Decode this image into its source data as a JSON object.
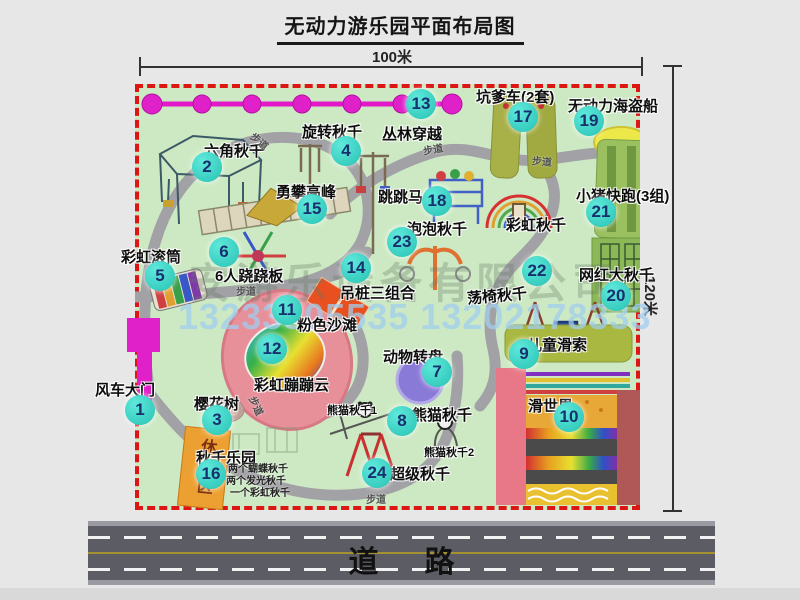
{
  "title": "无动力游乐园平面布局图",
  "dimensions": {
    "width": "100米",
    "height": "120米"
  },
  "road": {
    "label": "道路"
  },
  "watermarks": {
    "company": "安游乐设备有限公司",
    "phone": "13233805535 13202178333"
  },
  "map": {
    "path_label": "步道"
  },
  "attractions": [
    {
      "num": "1",
      "name": "风车大门"
    },
    {
      "num": "2",
      "name": "六角秋千"
    },
    {
      "num": "3",
      "name": "樱花树"
    },
    {
      "num": "4",
      "name": "旋转秋千"
    },
    {
      "num": "5",
      "name": "彩虹滚筒"
    },
    {
      "num": "6",
      "name": "6人跷跷板"
    },
    {
      "num": "7",
      "name": "动物转盘"
    },
    {
      "num": "8",
      "name": "熊猫秋千"
    },
    {
      "num": "9",
      "name": "儿童滑索"
    },
    {
      "num": "10",
      "name": "滑世界"
    },
    {
      "num": "11",
      "name": "粉色沙滩"
    },
    {
      "num": "12",
      "name": "彩虹蹦蹦云"
    },
    {
      "num": "13",
      "name": "丛林穿越"
    },
    {
      "num": "14",
      "name": "吊桩三组合"
    },
    {
      "num": "15",
      "name": "勇攀高峰"
    },
    {
      "num": "16",
      "name": "秋千乐园"
    },
    {
      "num": "17",
      "name": "坑爹车(2套)"
    },
    {
      "num": "18",
      "name": "跳跳马"
    },
    {
      "num": "19",
      "name": "无动力海盗船"
    },
    {
      "num": "20",
      "name": "网红大秋千"
    },
    {
      "num": "21",
      "name": "小猪快跑(3组)"
    },
    {
      "num": "22",
      "name": "荡椅秋千"
    },
    {
      "num": "23",
      "name": "泡泡秋千"
    },
    {
      "num": "24",
      "name": "超级秋千"
    }
  ],
  "extra_labels": {
    "rainbow_swing": "彩虹秋千",
    "panda_swing_1": "熊猫秋千1",
    "panda_swing_2": "熊猫秋千2",
    "rest_area": "休息区",
    "swing_park_note_1": "两个蝴蝶秋千",
    "swing_park_note_2": "两个发光秋千",
    "swing_park_note_3": "一个彩虹秋千"
  },
  "colors": {
    "map_green": "#cde9c4",
    "border_red": "#dd1515",
    "badge_turquoise": "#2fc8ba",
    "accent_magenta": "#e020c8",
    "road_gray": "#5c5c64",
    "rest_orange": "#eda032"
  }
}
